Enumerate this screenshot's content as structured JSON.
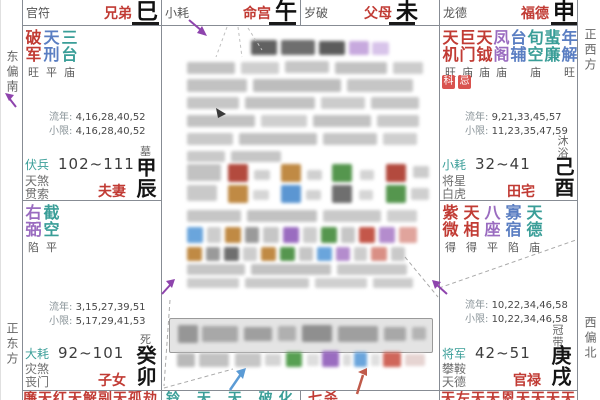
{
  "colors": {
    "red": "#c13b34",
    "teal": "#3a9e98",
    "purple": "#9a6cc0",
    "blue": "#5a7ec2",
    "badge": "#d9534f"
  },
  "labels": {
    "liunian": "流年:",
    "xiaoxian": "小限:"
  },
  "compass": {
    "east_south": "东偏南",
    "east": "正东方",
    "west": "正西方",
    "west_north": "西偏北"
  },
  "header_cells": [
    {
      "deity": "官符",
      "palace": "兄弟",
      "branch": "巳"
    },
    {
      "deity": "小耗",
      "palace": "命宫",
      "branch": "午"
    },
    {
      "deity": "岁破",
      "palace": "父母",
      "branch": "未"
    },
    {
      "deity": "龙德",
      "palace": "福德",
      "branch": "申"
    }
  ],
  "palaces": {
    "chen": {
      "stars": [
        {
          "top": "破",
          "bot": "军",
          "bright": "旺",
          "color": "#c13b34"
        },
        {
          "top": "天",
          "bot": "刑",
          "bright": "平",
          "color": "#5a7ec2"
        },
        {
          "top": "三",
          "bot": "台",
          "bright": "庙",
          "color": "#3a9e98"
        }
      ],
      "liunian": "4,16,28,40,52",
      "xiaoxian": "4,16,28,40,52",
      "deity": {
        "text": "伏兵",
        "color": "#3a9e98"
      },
      "range": "102~111",
      "minor1": "天煞",
      "minor2": "贯索",
      "longevity": "墓",
      "palace": "夫妻",
      "branch": "甲辰"
    },
    "mao": {
      "stars": [
        {
          "top": "右",
          "bot": "弼",
          "bright": "陷",
          "color": "#9a6cc0"
        },
        {
          "top": "截",
          "bot": "空",
          "bright": "平",
          "color": "#3a9e98"
        }
      ],
      "liunian": "3,15,27,39,51",
      "xiaoxian": "5,17,29,41,53",
      "deity": {
        "text": "大耗",
        "color": "#3a9e98"
      },
      "range": "92~101",
      "minor1": "灾煞",
      "minor2": "丧门",
      "longevity": "死",
      "palace": "子女",
      "branch": "癸卯"
    },
    "you": {
      "stars": [
        {
          "top": "天",
          "bot": "机",
          "bright": "旺",
          "color": "#c13b34"
        },
        {
          "top": "巨",
          "bot": "门",
          "bright": "庙",
          "color": "#c13b34"
        },
        {
          "top": "天",
          "bot": "钺",
          "bright": "庙",
          "color": "#c13b34"
        },
        {
          "top": "凤",
          "bot": "阁",
          "bright": "庙",
          "color": "#9a6cc0"
        },
        {
          "top": "台",
          "bot": "辅",
          "bright": "",
          "color": "#5a7ec2"
        },
        {
          "top": "旬",
          "bot": "空",
          "bright": "庙",
          "color": "#3a9e98"
        },
        {
          "top": "蜚",
          "bot": "廉",
          "bright": "",
          "color": "#3a9e98"
        },
        {
          "top": "年",
          "bot": "解",
          "bright": "旺",
          "color": "#5a7ec2"
        }
      ],
      "badges": [
        "科",
        "忌"
      ],
      "liunian": "9,21,33,45,57",
      "xiaoxian": "11,23,35,47,59",
      "deity": {
        "text": "小耗",
        "color": "#3a9e98"
      },
      "range": "32~41",
      "minor1": "将星",
      "minor2": "白虎",
      "longevity": "沐浴",
      "palace": "田宅",
      "branch": "己酉"
    },
    "xu": {
      "stars": [
        {
          "top": "紫",
          "bot": "微",
          "bright": "得",
          "color": "#c13b34"
        },
        {
          "top": "天",
          "bot": "相",
          "bright": "得",
          "color": "#c13b34"
        },
        {
          "top": "八",
          "bot": "座",
          "bright": "平",
          "color": "#9a6cc0"
        },
        {
          "top": "寡",
          "bot": "宿",
          "bright": "陷",
          "color": "#5a7ec2"
        },
        {
          "top": "天",
          "bot": "德",
          "bright": "庙",
          "color": "#3a9e98"
        }
      ],
      "liunian": "10,22,34,46,58",
      "xiaoxian": "10,22,34,46,58",
      "deity": {
        "text": "将军",
        "color": "#3a9e98"
      },
      "range": "42~51",
      "minor1": "攀鞍",
      "minor2": "天德",
      "longevity": "冠带",
      "palace": "官禄",
      "branch": "庚戌"
    }
  },
  "bottom_row": [
    {
      "text": "廉天红天解副天孤劫",
      "color": "#c13b34"
    },
    {
      "text": "铃 天 天 破化",
      "color": "#3a9e98"
    },
    {
      "text": "七杀",
      "color": "#c13b34"
    },
    {
      "text": "天左天天恩天天天天",
      "color": "#c13b34"
    }
  ]
}
